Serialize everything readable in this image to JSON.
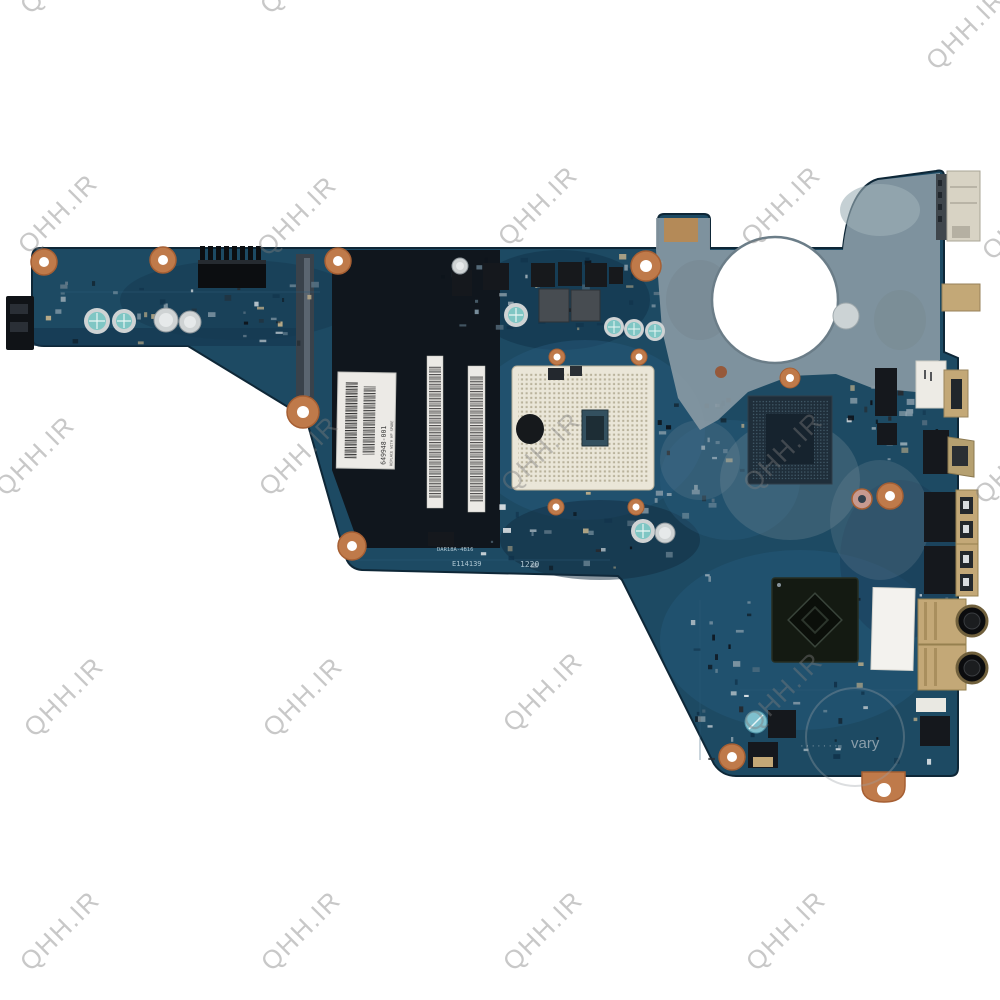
{
  "image_type": "watermarked product photo of a laptop motherboard",
  "watermark": {
    "text": "QHH.IR",
    "positions": [
      [
        60,
        -26
      ],
      [
        300,
        -26
      ],
      [
        966,
        30
      ],
      [
        58,
        214
      ],
      [
        297,
        216
      ],
      [
        538,
        206
      ],
      [
        781,
        206
      ],
      [
        1022,
        220
      ],
      [
        35,
        456
      ],
      [
        299,
        456
      ],
      [
        541,
        452
      ],
      [
        783,
        452
      ],
      [
        1014,
        464
      ],
      [
        64,
        697
      ],
      [
        303,
        697
      ],
      [
        543,
        692
      ],
      [
        783,
        692
      ],
      [
        60,
        931
      ],
      [
        301,
        931
      ],
      [
        543,
        931
      ],
      [
        786,
        931
      ]
    ]
  },
  "stamp": {
    "text": "vary",
    "dots": "·······"
  },
  "board": {
    "silkscreen": {
      "model": "DAR18A-4B16",
      "serial": "E114139",
      "date_code": "1220"
    },
    "hp_label": {
      "part_number": "649948-001",
      "note": "REPLACE WITH HP SPARE"
    },
    "colors": {
      "pcb": "#1d4a63",
      "ram": "#10161d",
      "residue": "#8a9aa4",
      "copper": "#bf7a4a",
      "socket": "#eae6d8",
      "tan": "#c3a877",
      "portblack": "#15181d",
      "capteal": "#7fc6c4",
      "capsilver": "#cfd3d4",
      "label": "#eceae6",
      "amd": "#141a12",
      "silk": "#cfe3ec",
      "wm": "#7d7d7d"
    }
  }
}
